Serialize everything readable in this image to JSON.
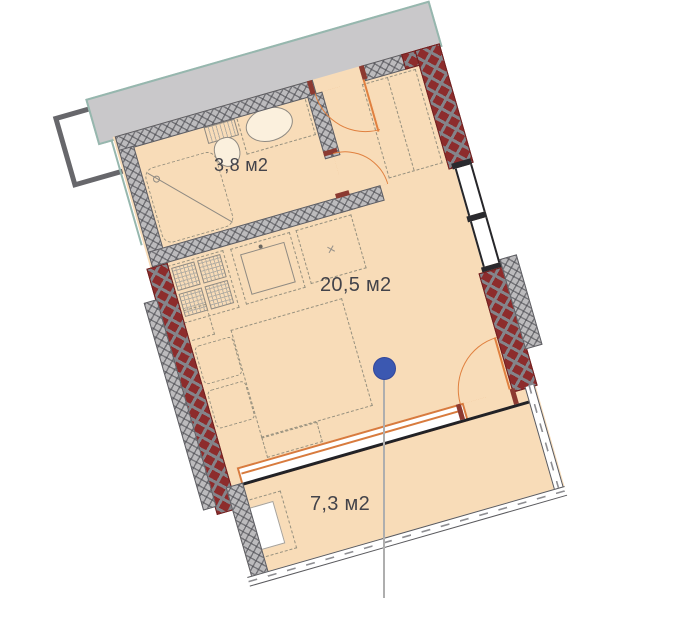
{
  "plan": {
    "rooms": [
      {
        "id": "bathroom",
        "area_label": "3,8 м2"
      },
      {
        "id": "living-room",
        "area_label": "20,5 м2"
      },
      {
        "id": "balcony",
        "area_label": "7,3 м2"
      }
    ],
    "fridge_niche_mark": "×",
    "marker": {
      "shape": "circle-pin",
      "color": "#3b58b1"
    },
    "colors": {
      "floor": "#f8dcb8",
      "load_bearing_wall": "#8d2c2c",
      "partition_wall": "#bcbbbd",
      "door_window_accent": "#e0803f",
      "neighbor_zone": "#c9c8ca",
      "boundary_line": "#96b7ae"
    }
  }
}
